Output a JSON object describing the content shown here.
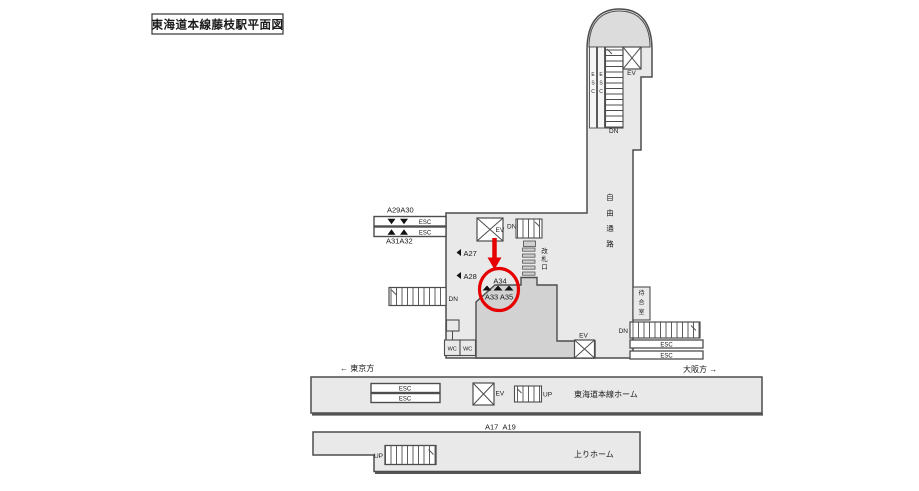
{
  "title": "東海道本線藤枝駅平面図",
  "colors": {
    "building": "#e9e9e9",
    "paid_area": "#d2d2d2",
    "dome_cap": "#dcdcdc",
    "outline": "#4d4d4d",
    "bar_fill": "#ffffff",
    "gate_fill": "#cfcfcf",
    "highlight_red": "#e60000"
  },
  "labels": {
    "esc": "ESC",
    "ev": "EV",
    "dn": "DN",
    "up": "UP",
    "wc": "WC"
  },
  "areas": {
    "free_passage": "自由通路",
    "waiting_room": "待合室",
    "ticket_gate": "改札口",
    "main_platform": "東海道本線ホーム",
    "up_platform": "上りホーム"
  },
  "directions": {
    "tokyo": "← 東京方",
    "osaka": "大阪方 →"
  },
  "ads": {
    "a29_a30": "A29A30",
    "a31_a32": "A31A32",
    "a27": "A27",
    "a28": "A28",
    "a34": "A34",
    "a33_a35": "A33 A35",
    "a17": "A17",
    "a19": "A19",
    "a16": "A16",
    "a18": "A18",
    "a20": "A20"
  }
}
